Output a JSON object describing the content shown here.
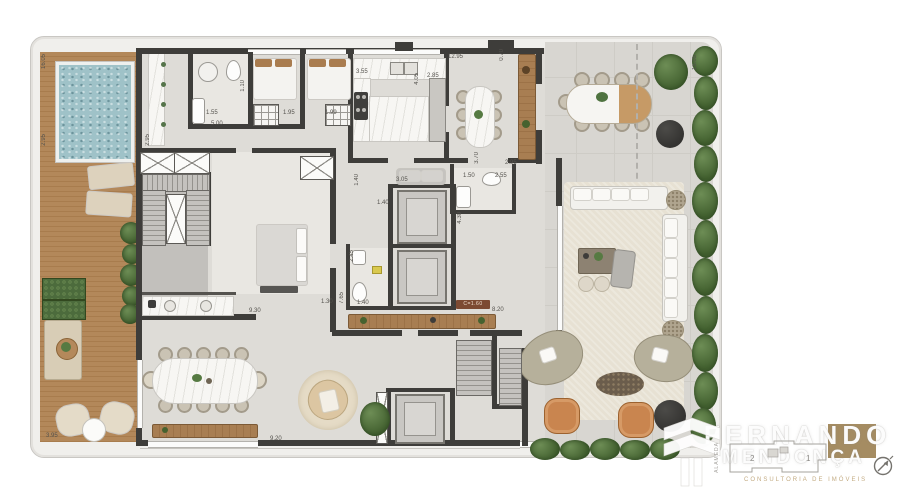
{
  "plan_title": "penthouse-floor-plan",
  "dims": [
    "16.05",
    "2.95",
    "3.95",
    "2.95",
    "1.55",
    "5.00",
    "1.95",
    "1.99",
    "1.10",
    "3.55",
    "2.85",
    "4.05",
    "12.95",
    "0.70",
    "2.95",
    "3.70",
    "3.05",
    "1.50",
    "2.55",
    "1.40",
    "1.40",
    "2.45",
    "7.65",
    "1.40",
    "4.30",
    "8.20",
    "9.30",
    "1.30",
    "9.20",
    "15.05"
  ],
  "badges": {
    "ceiling_height": "C=1.60"
  },
  "watermark": {
    "line1": "FERNANDO",
    "line2": "MENDONÇA",
    "tagline": "CONSULTORIA DE IMÓVEIS"
  },
  "keyplan": {
    "unit_left_label": "2",
    "unit_right_label": "1",
    "street_label": "ALAMEDA"
  },
  "colors": {
    "wall": "#3e3d3a",
    "deck_wood": "#ac7f50",
    "pool_water": "#9fc2c8",
    "floor_interior": "#dedcd7",
    "floor_terrace": "#d8d6d1",
    "hedge_green": "#50713f",
    "accent_wood": "#a27a4f",
    "leather_chair": "#c9854f",
    "watermark_box": "#a58c62",
    "dark_planter": "#3a3937"
  }
}
